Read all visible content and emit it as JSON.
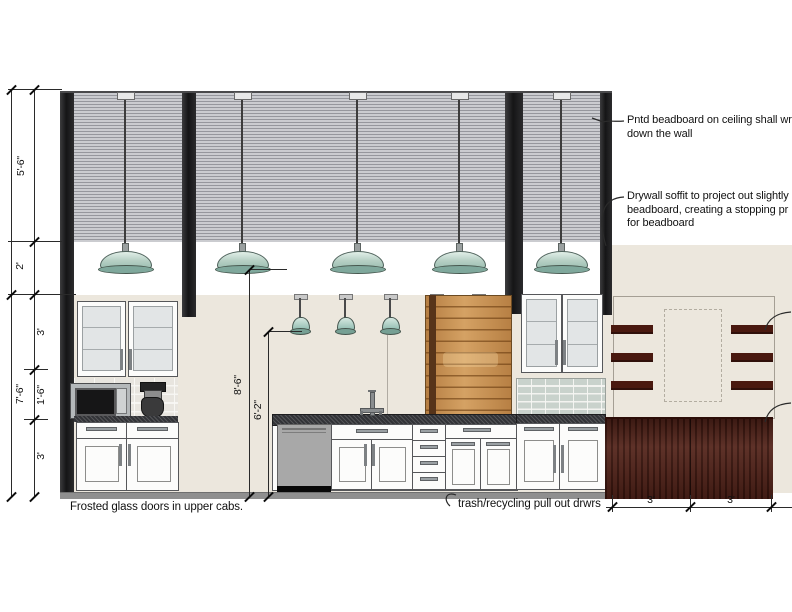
{
  "dims": {
    "ceiling_band": "5'-6\"",
    "soffit": "2'",
    "upper_cabs": "3'",
    "mid_band": "1'-6\"",
    "base_cabs": "3'",
    "wall_total": "7'-6\"",
    "large_pendant_height": "8'-6\"",
    "small_pendant_height": "6'-2\"",
    "dining_left": "3'",
    "dining_right": "3'"
  },
  "notes": {
    "beadboard_line1": "Pntd beadboard on ceiling shall wr",
    "beadboard_line2": "down the wall",
    "soffit_line1": "Drywall soffit to project out slightly",
    "soffit_line2": "beadboard, creating a stopping pr",
    "soffit_line3": "for beadboard",
    "frosted": "Frosted glass doors in upper cabs.",
    "trash": "trash/recycling pull out drwrs"
  },
  "colors": {
    "wall": "#ece7dd",
    "beadboard": "#c9cacd",
    "column": "#1f1f20",
    "pendant_shade": "#aecbbf",
    "wood_cabinet": "#c99050",
    "wainscot": "#4d1b11",
    "counter": "#323337",
    "tile": "#c9d2cc",
    "dishwasher": "#a6a6a6"
  }
}
